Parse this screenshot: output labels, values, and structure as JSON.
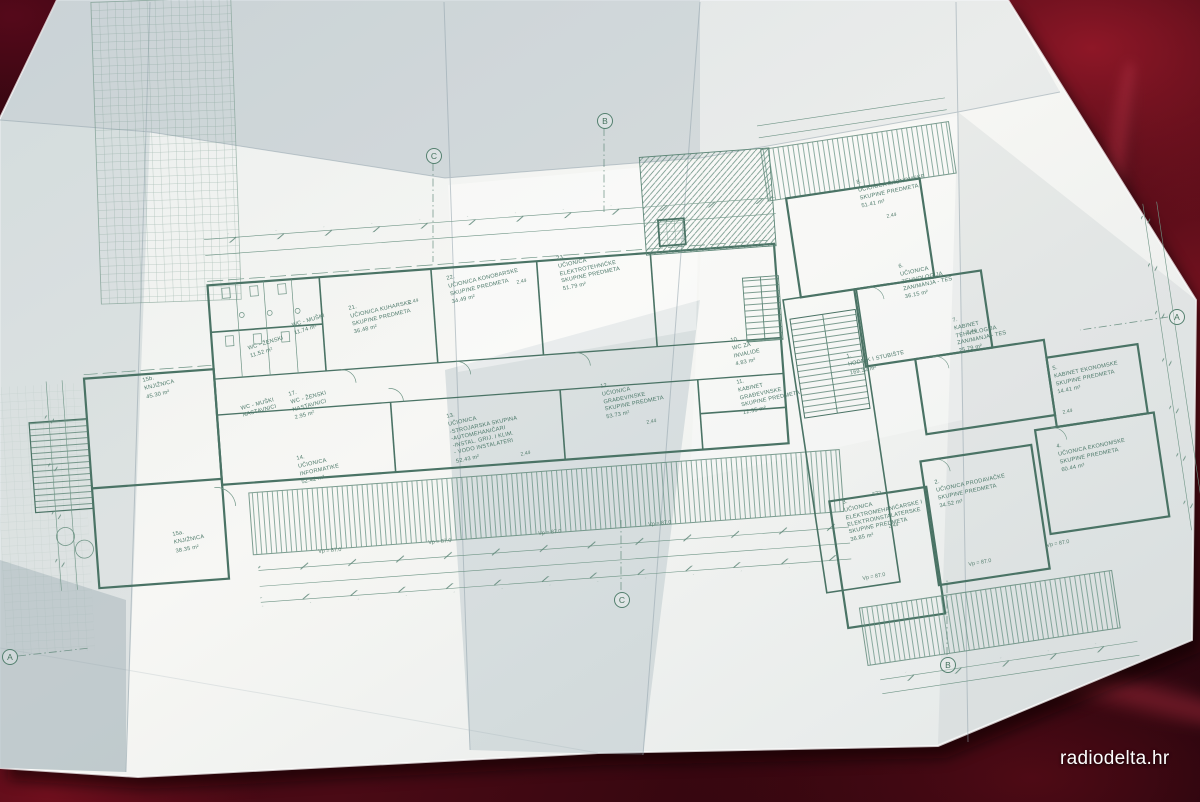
{
  "watermark": {
    "text": "radiodelta.hr"
  },
  "palette": {
    "fabric_dark": "#30060e",
    "fabric_bright": "#8e1727",
    "paper": "#f4f5f2",
    "paper_shadow": "#c9d2d6",
    "ink": "#4e7a6b"
  },
  "plan": {
    "rooms": [
      {
        "num": "15b.",
        "lines": [
          "KNJIŽNICA"
        ],
        "area": "45.30 m²",
        "x": 142,
        "y": 378,
        "rot": -13
      },
      {
        "num": "",
        "lines": [
          "WC - ŽENSKI"
        ],
        "area": "11.52 m²",
        "x": 247,
        "y": 345,
        "rot": -17
      },
      {
        "num": "",
        "lines": [
          "WC - MUŠKI"
        ],
        "area": "11.74 m²",
        "x": 291,
        "y": 322,
        "rot": -17
      },
      {
        "num": "",
        "lines": [
          "WC - MUŠKI",
          "NASTAVNICI"
        ],
        "area": "",
        "x": 240,
        "y": 405,
        "rot": -15
      },
      {
        "num": "17.",
        "lines": [
          "WC - ŽENSKI",
          "NASTAVNICI"
        ],
        "area": "2.95 m²",
        "x": 288,
        "y": 392,
        "rot": -15
      },
      {
        "num": "21.",
        "lines": [
          "UČIONICA KUHARSKE",
          "SKUPINE PREDMETA"
        ],
        "area": "36.48 m²",
        "x": 348,
        "y": 306,
        "rot": -13
      },
      {
        "num": "22.",
        "lines": [
          "UČIONICA KONOBARSKE",
          "SKUPINE PREDMETA"
        ],
        "area": "34.49 m²",
        "x": 446,
        "y": 276,
        "rot": -13
      },
      {
        "num": "23.",
        "lines": [
          "UČIONICA",
          "ELEKTROTEHNIČKE",
          "SKUPINE PREDMETA"
        ],
        "area": "51.79 m²",
        "x": 556,
        "y": 256,
        "rot": -12
      },
      {
        "num": "14.",
        "lines": [
          "UČIONICA",
          "INFORMATIKE"
        ],
        "area": "52.42 m²",
        "x": 296,
        "y": 456,
        "rot": -12
      },
      {
        "num": "13.",
        "lines": [
          "UČIONICA",
          "-STROJARSKA SKUPINA",
          "-AUTOMEHANIČARI",
          "-INSTAL. GRIJ. I KLIM.",
          "- VODO INSTALATERI"
        ],
        "area": "52.43 m²",
        "x": 446,
        "y": 414,
        "rot": -12
      },
      {
        "num": "12.",
        "lines": [
          "UČIONICA",
          "GRAĐEVINSKE",
          "SKUPINE PREDMETA"
        ],
        "area": "53.73 m²",
        "x": 600,
        "y": 384,
        "rot": -11
      },
      {
        "num": "10.",
        "lines": [
          "WC ZA",
          "INVALIDE"
        ],
        "area": "4.83 m²",
        "x": 730,
        "y": 338,
        "rot": -12
      },
      {
        "num": "11.",
        "lines": [
          "KABINET",
          "GRAĐEVINSKE",
          "SKUPINE PREDMETA"
        ],
        "area": "12.35 m²",
        "x": 736,
        "y": 380,
        "rot": -12
      },
      {
        "num": "15a.",
        "lines": [
          "KNJIŽNICA"
        ],
        "area": "38.35 m²",
        "x": 172,
        "y": 532,
        "rot": -11
      },
      {
        "num": "8.",
        "lines": [
          "UČIONICA EKONOMSKE",
          "SKUPINE PREDMETA"
        ],
        "area": "51.41 m²",
        "x": 856,
        "y": 180,
        "rot": -12
      },
      {
        "num": "6.",
        "lines": [
          "UČIONICA",
          "TEHNOLOGIJA",
          "ZANIMANJA - TES"
        ],
        "area": "36.15 m²",
        "x": 898,
        "y": 264,
        "rot": -12
      },
      {
        "num": "7.",
        "lines": [
          "KABINET",
          "TEHNOLOGIJA",
          "ZANIMANJA - TES"
        ],
        "area": "25.79 m²",
        "x": 952,
        "y": 318,
        "rot": -12
      },
      {
        "num": "1.",
        "lines": [
          "HODNIK I STUBIŠTE"
        ],
        "area": "169.32 m²",
        "x": 846,
        "y": 354,
        "rot": -12
      },
      {
        "num": "5.",
        "lines": [
          "KABINET EKONOMSKE",
          "SKUPINE PREDMETA"
        ],
        "area": "14.41 m²",
        "x": 1052,
        "y": 366,
        "rot": -12
      },
      {
        "num": "4.",
        "lines": [
          "UČIONICA EKONOMSKE",
          "SKUPINE PREDMETA"
        ],
        "area": "60.44 m²",
        "x": 1056,
        "y": 444,
        "rot": -12
      },
      {
        "num": "3.",
        "lines": [
          "UČIONICA",
          "ELEKTROMEHANIČARSKE I",
          "ELEKTROINSTALATERSKE",
          "SKUPINE PREDMETA"
        ],
        "area": "36.85 m²",
        "x": 842,
        "y": 500,
        "rot": -12
      },
      {
        "num": "2.",
        "lines": [
          "UČIONICA PRODAVAČKE",
          "SKUPINE PREDMETA"
        ],
        "area": "34.52 m²",
        "x": 934,
        "y": 480,
        "rot": -12
      }
    ],
    "dimensions": [
      {
        "text": "Vp = 87.0",
        "x": 318,
        "y": 549,
        "rot": -5
      },
      {
        "text": "Vp = 87.0",
        "x": 428,
        "y": 540,
        "rot": -5
      },
      {
        "text": "Vp = 87.0",
        "x": 538,
        "y": 531,
        "rot": -6
      },
      {
        "text": "Vp = 87.0",
        "x": 648,
        "y": 522,
        "rot": -6
      },
      {
        "text": "Vp = 87.0",
        "x": 862,
        "y": 576,
        "rot": -10
      },
      {
        "text": "Vp = 87.0",
        "x": 968,
        "y": 562,
        "rot": -10
      },
      {
        "text": "Vp = 87.0",
        "x": 1046,
        "y": 543,
        "rot": -10
      },
      {
        "text": "572",
        "x": 872,
        "y": 492,
        "rot": -10
      }
    ],
    "levels": [
      {
        "text": "2.44",
        "x": 408,
        "y": 300,
        "rot": -13
      },
      {
        "text": "2.44",
        "x": 516,
        "y": 280,
        "rot": -12
      },
      {
        "text": "2.44",
        "x": 520,
        "y": 452,
        "rot": -12
      },
      {
        "text": "2.44",
        "x": 646,
        "y": 420,
        "rot": -11
      },
      {
        "text": "2.44",
        "x": 886,
        "y": 214,
        "rot": -12
      },
      {
        "text": "2.44",
        "x": 966,
        "y": 330,
        "rot": -12
      },
      {
        "text": "2.44",
        "x": 1062,
        "y": 410,
        "rot": -12
      },
      {
        "text": "2.44",
        "x": 888,
        "y": 524,
        "rot": -12
      }
    ],
    "axis_markers": [
      {
        "label": "C",
        "x": 426,
        "y": 148
      },
      {
        "label": "B",
        "x": 597,
        "y": 113
      },
      {
        "label": "A",
        "x": 1169,
        "y": 309
      },
      {
        "label": "B",
        "x": 940,
        "y": 657
      },
      {
        "label": "C",
        "x": 614,
        "y": 592
      },
      {
        "label": "A",
        "x": 2,
        "y": 649
      }
    ]
  }
}
